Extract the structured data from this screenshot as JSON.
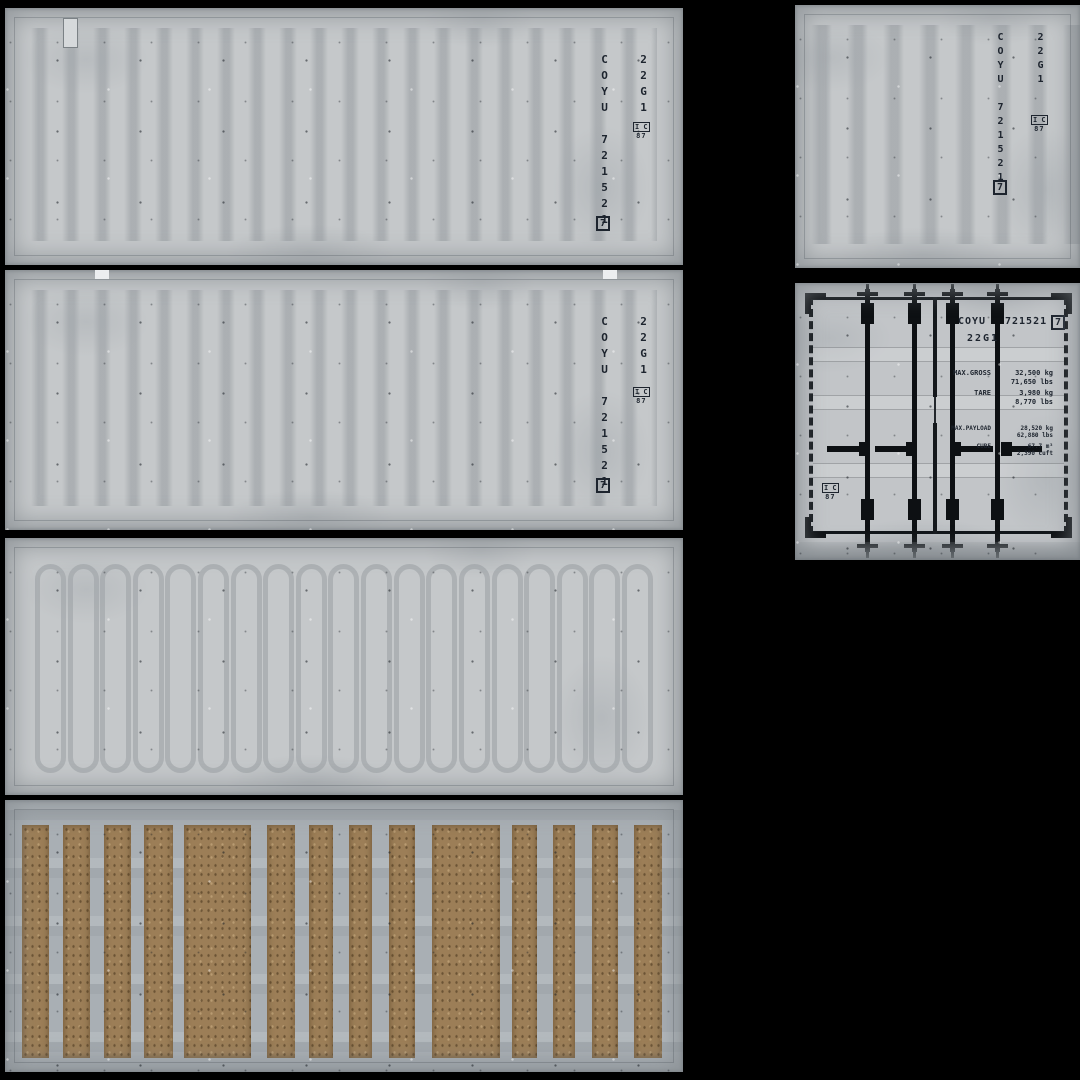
{
  "markings": {
    "vertical_id": "COYU 721521",
    "owner_code": "COYU",
    "serial_number": "721521",
    "check_digit": "7",
    "iso_type_code": "22G1",
    "emblem_top": "I C",
    "emblem_bottom": "87"
  },
  "door_specs": {
    "rows": [
      {
        "label": "MAX.GROSS",
        "metric": "32,500 kg",
        "imperial": "71,650 lbs"
      },
      {
        "label": "TARE",
        "metric": "3,980 kg",
        "imperial": "8,770 lbs"
      },
      {
        "label": "MAX.PAYLOAD",
        "metric": "28,520 kg",
        "imperial": "62,880 lbs"
      },
      {
        "label": "CUBE",
        "metric": "67.7 m³",
        "imperial": "2,390 cuft"
      }
    ]
  },
  "colors": {
    "background": "#000000",
    "panel_gray": "#c5c8ca",
    "rib_gray": "#9aa0a5",
    "floor_metal": "#a9afb4",
    "wood_brown": "#9c7e57",
    "hardware_black": "#0d1013",
    "stencil_ink": "#1d242e"
  }
}
